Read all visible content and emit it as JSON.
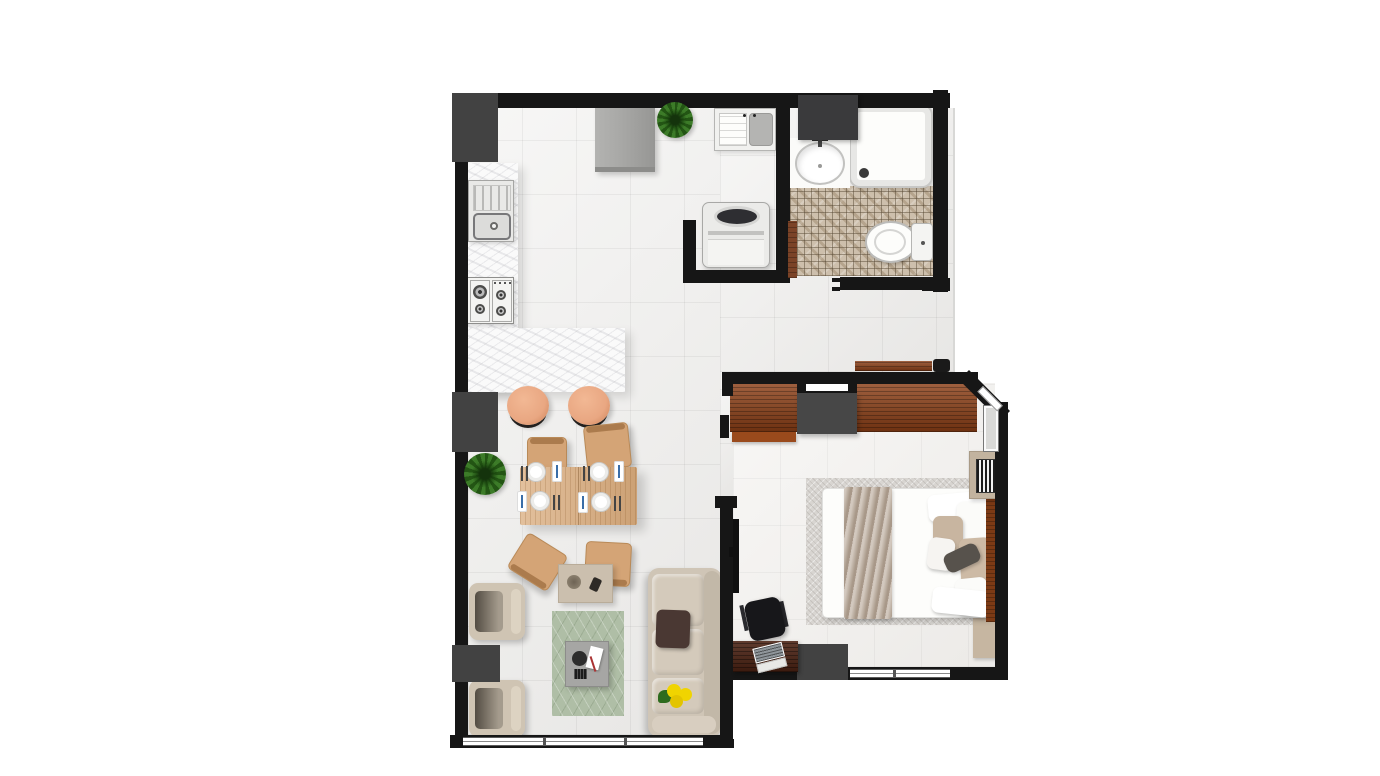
{
  "scene": {
    "type": "floor-plan",
    "view": "top-down-3d-render",
    "description": "Studio apartment floor plan with open kitchen, dining and living area, laundry closet, bathroom and bedroom"
  },
  "palette": {
    "wall": "#161616",
    "column": "#424242",
    "floorTile": "#edecea",
    "floorBed": "#f1efec",
    "marble": "#fafafa",
    "mosaic": "#cdbfac",
    "woodWardrobe": "#8c3f16",
    "woodDesk": "#4a2112",
    "woodDining": "#d9ab7c",
    "woodDoor": "#7b4327",
    "headboard": "#7c3a15",
    "sofa": "#cfc5b6",
    "armchair": "#cfc4b3",
    "cushion": "#d4cabb",
    "rugGreen": "#afbea6",
    "rugBed": "#d8d5d1",
    "blanket": "#b5a493",
    "pillowBeige": "#c8b5a0",
    "stool": "#e9a782",
    "appliance": "#a9a9a7",
    "white": "#fdfdfb",
    "plant": "#3c7b28",
    "accent": "#f0d400",
    "tv": "#101010",
    "consoleTan": "#cbbfae",
    "benchTan": "#c6b6a1",
    "coffeeTable": "#a6a6a4",
    "pillowDark": "#4a3833"
  },
  "rooms": [
    {
      "name": "kitchen",
      "items": [
        "marble-counter",
        "kitchen-sink",
        "gas-cooktop",
        "fridge",
        "plant"
      ]
    },
    {
      "name": "laundry-closet",
      "items": [
        "laundry-sink",
        "washing-machine"
      ]
    },
    {
      "name": "bathroom",
      "items": [
        "vanity-sink",
        "shower",
        "toilet",
        "mosaic-floor",
        "open-door"
      ]
    },
    {
      "name": "dining",
      "items": [
        "dining-table",
        "four-chairs",
        "four-place-settings",
        "two-bar-stools",
        "plant"
      ]
    },
    {
      "name": "living",
      "items": [
        "sofa",
        "two-armchairs",
        "coffee-table",
        "console-table",
        "green-rug",
        "window"
      ]
    },
    {
      "name": "bedroom",
      "items": [
        "double-bed",
        "wardrobe",
        "headboard",
        "bookshelf",
        "desk",
        "laptop",
        "office-chair",
        "tv",
        "windows"
      ]
    }
  ]
}
